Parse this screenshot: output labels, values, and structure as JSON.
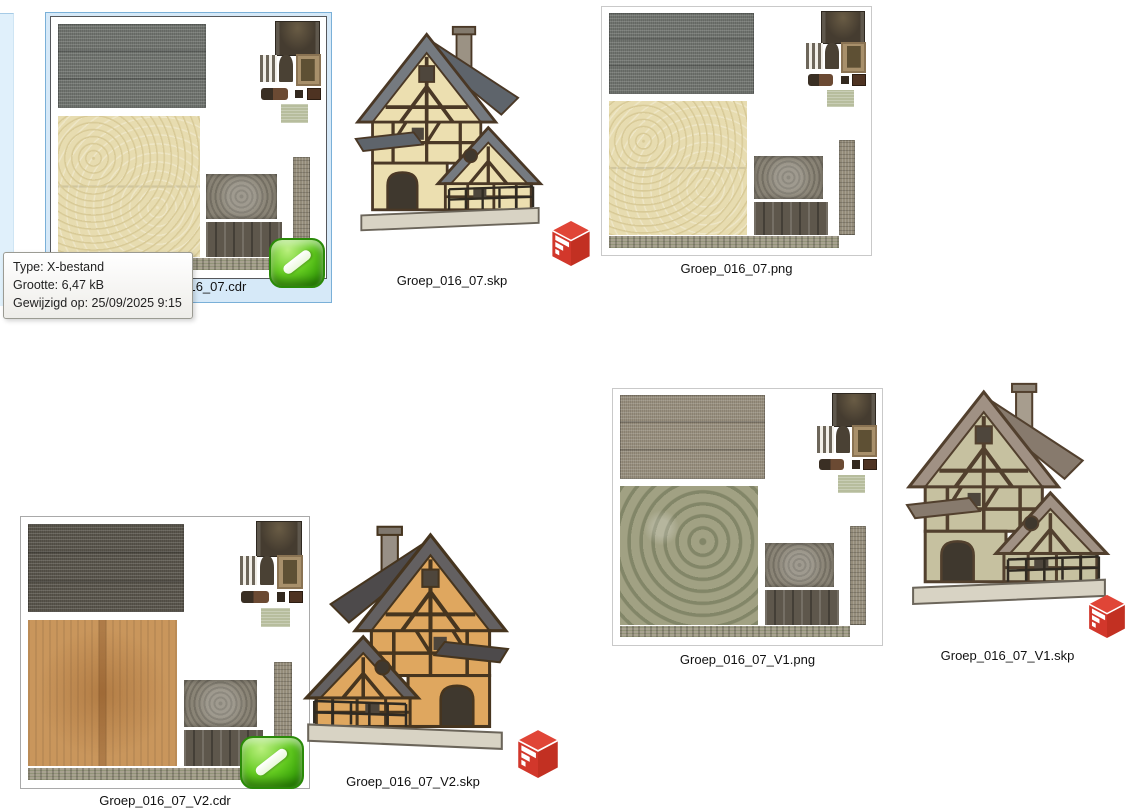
{
  "tooltip": {
    "type_line": "Type: X-bestand",
    "size_line": "Grootte: 6,47 kB",
    "modified_line": "Gewijzigd op: 25/09/2025 9:15"
  },
  "items": {
    "cdr_main": {
      "visible_label": "_016_07.cdr",
      "selected": true,
      "kind": "texture-atlas",
      "overlay_icon": "edit-pen-overlay-icon"
    },
    "skp_main": {
      "label": "Groep_016_07.skp",
      "kind": "sketchup-model",
      "badge_icon": "sketchup-logo-icon"
    },
    "png_main": {
      "label": "Groep_016_07.png",
      "kind": "texture-atlas"
    },
    "png_v1": {
      "label": "Groep_016_07_V1.png",
      "kind": "texture-atlas"
    },
    "skp_v1": {
      "label": "Groep_016_07_V1.skp",
      "kind": "sketchup-model",
      "badge_icon": "sketchup-logo-icon"
    },
    "cdr_v2": {
      "label": "Groep_016_07_V2.cdr",
      "kind": "texture-atlas",
      "overlay_icon": "edit-pen-overlay-icon"
    },
    "skp_v2": {
      "label": "Groep_016_07_V2.skp",
      "kind": "sketchup-model",
      "badge_icon": "sketchup-logo-icon"
    }
  },
  "colors": {
    "selection_fill": "#d6e9f8",
    "selection_border": "#7ab0d8",
    "sketchup_red": "#d63c2e",
    "overlay_green": "#4db313",
    "label_text": "#111111"
  }
}
